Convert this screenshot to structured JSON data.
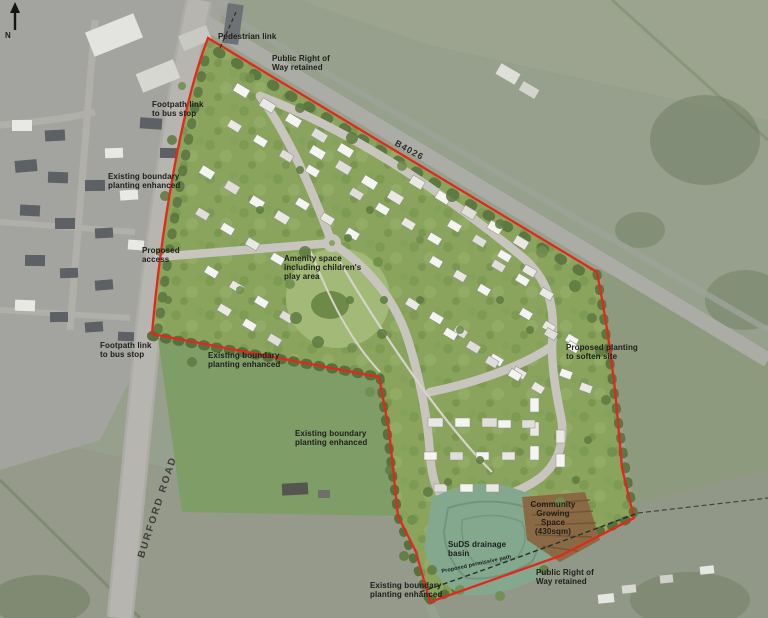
{
  "compass": {
    "north": "N"
  },
  "roads": {
    "burford": "BURFORD ROAD",
    "b4026": "B4026"
  },
  "annotations": {
    "pedestrian_link": "Pedestrian link",
    "prow_top": "Public Right of\nWay retained",
    "footpath_bus_upper": "Footpath link\nto bus stop",
    "boundary_planting_west": "Existing boundary\nplanting enhanced",
    "proposed_access": "Proposed\naccess",
    "footpath_bus_lower": "Footpath link\nto bus stop",
    "boundary_planting_north_pitch": "Existing boundary\nplanting enhanced",
    "amenity_space": "Amenity space\nincluding children's\nplay area",
    "proposed_planting_east": "Proposed planting\nto soften site",
    "boundary_planting_east_pitch": "Existing boundary\nplanting enhanced",
    "suds_basin": "SuDS drainage\nbasin",
    "community_growing": "Community\nGrowing\nSpace\n(430sqm)",
    "permissive_path": "Proposed permissive path",
    "prow_bottom": "Public Right of\nWay retained",
    "boundary_planting_south": "Existing boundary\nplanting enhanced"
  },
  "legend_colors": {
    "site_boundary_red": "#e6261c",
    "site_green": "#8aa45e",
    "amenity_green": "#a3b977",
    "suds_basin_green": "#7ea88c",
    "community_growing_brown": "#8a6a44",
    "estate_road_grey": "#c7c5be"
  }
}
